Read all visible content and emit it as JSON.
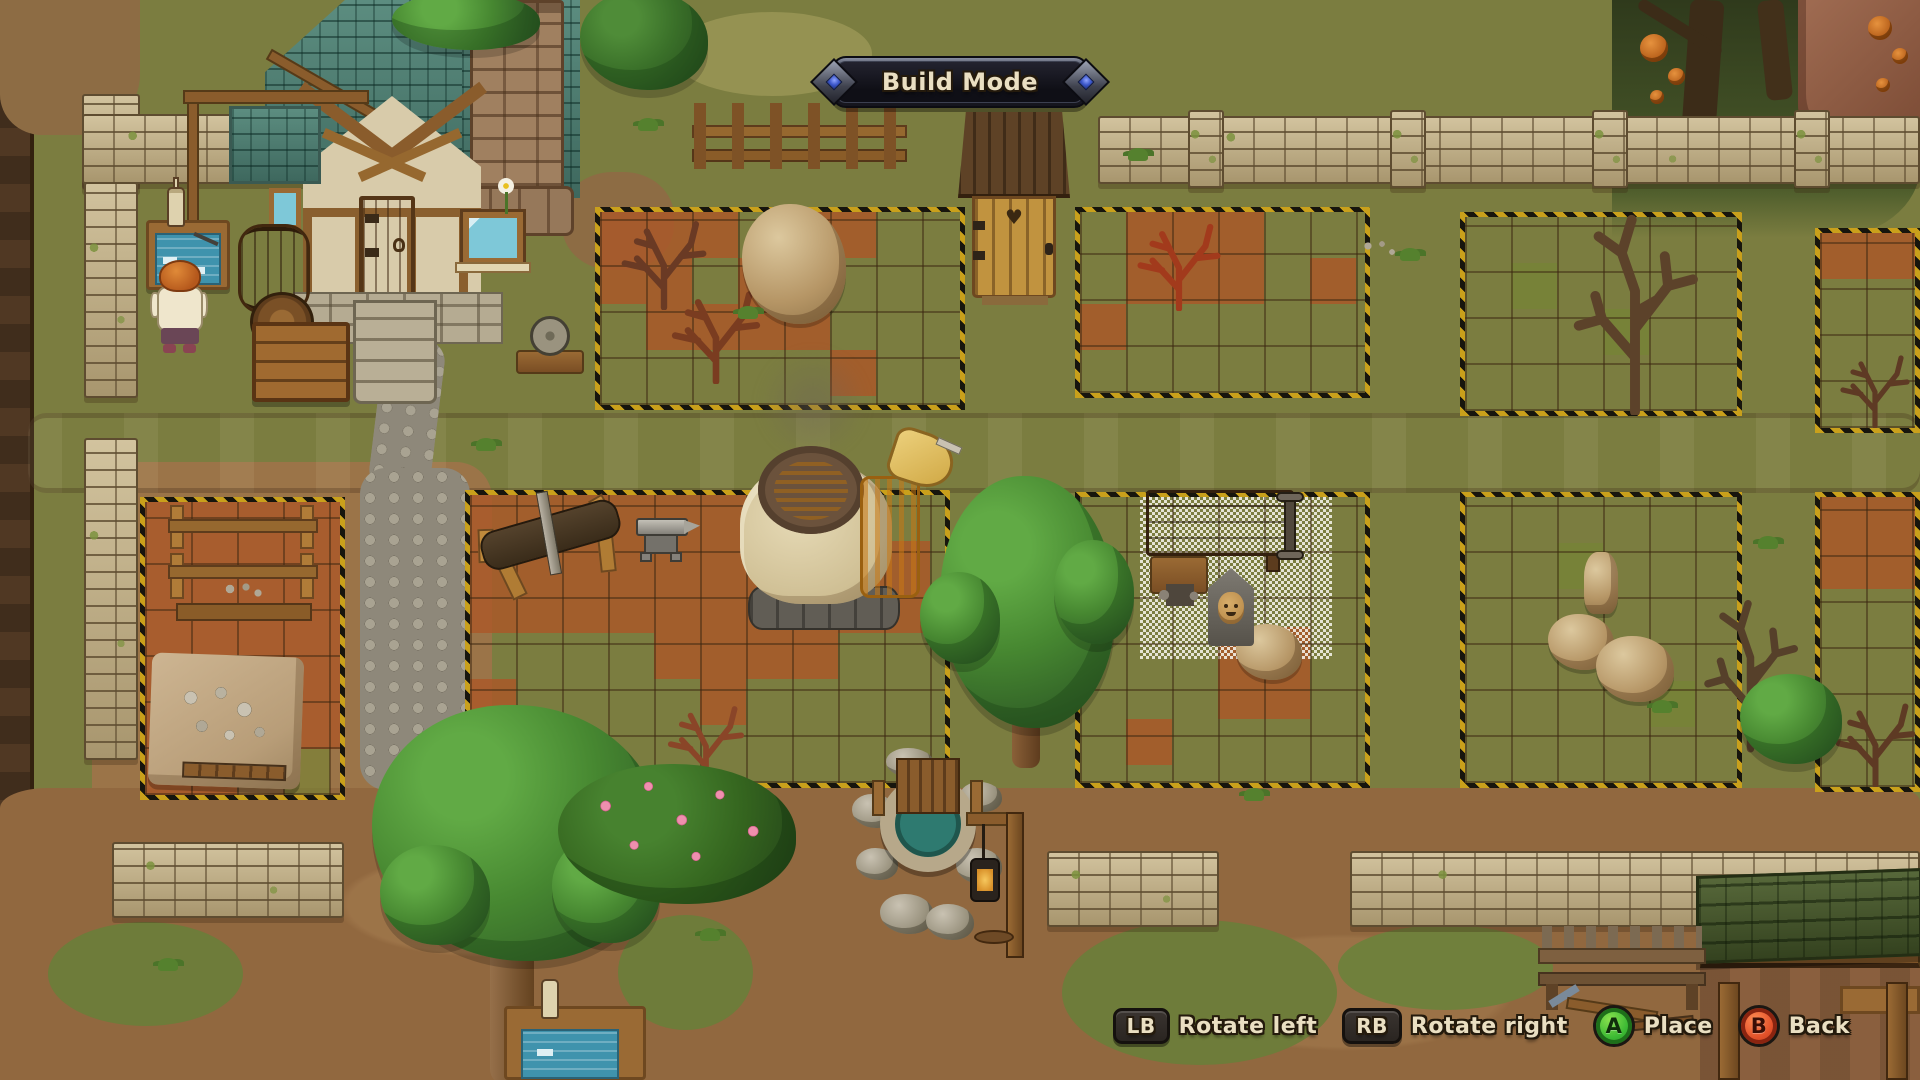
{
  "hud": {
    "banner": {
      "label": "Build Mode"
    },
    "hints": [
      {
        "button": "LB",
        "label": "Rotate left",
        "style": "shoulder"
      },
      {
        "button": "RB",
        "label": "Rotate right",
        "style": "shoulder"
      },
      {
        "button": "A",
        "label": "Place",
        "style": "face",
        "color": "#3cba34"
      },
      {
        "button": "B",
        "label": "Back",
        "style": "face",
        "color": "#e2512a"
      }
    ],
    "text_color": "#eadfc2",
    "outline_color": "#241a0c"
  },
  "scene": {
    "mode": "build",
    "objects": [
      "house",
      "outhouse",
      "stone-walls",
      "build-zones",
      "furnace",
      "anvil",
      "sawhorse",
      "workbench",
      "drying-rack",
      "stone-tarp",
      "well",
      "lantern-post",
      "shed",
      "drafting-table",
      "trees",
      "rocks",
      "dead-bushes"
    ]
  }
}
